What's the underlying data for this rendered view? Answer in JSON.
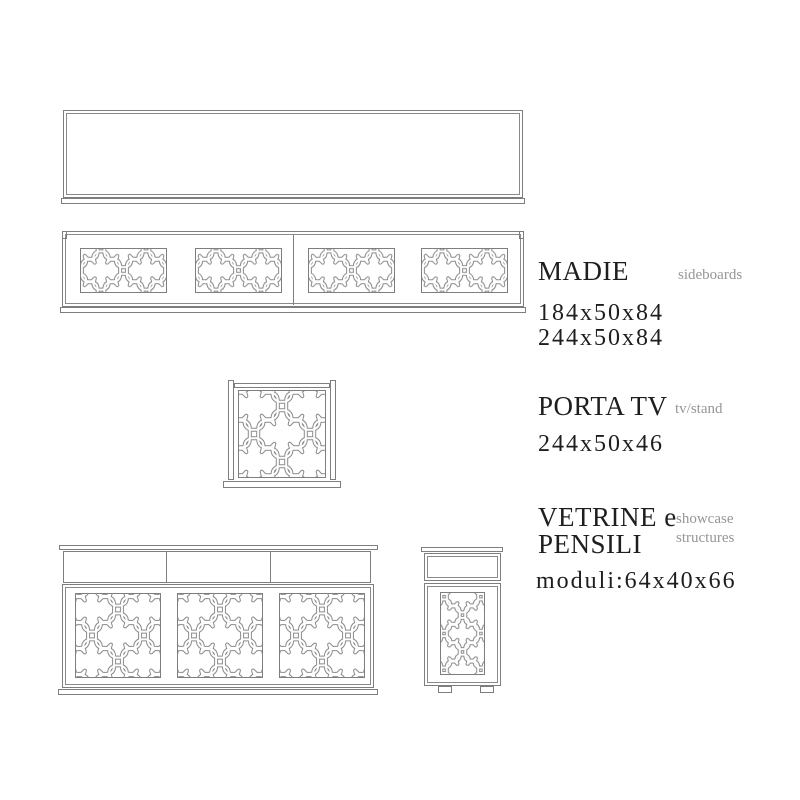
{
  "palette": {
    "background": "#ffffff",
    "drawing_line": "#7e7e7e",
    "pattern_line": "#8a8a8a",
    "text": "#1e1e1e",
    "muted_text": "#969696"
  },
  "sections": {
    "madie": {
      "title": "MADIE",
      "subtitle": "sideboards",
      "dims": [
        "184x50x84",
        "244x50x84"
      ]
    },
    "porta_tv": {
      "title": "PORTA TV",
      "subtitle": "tv/stand",
      "dims": [
        "244x50x46"
      ]
    },
    "vetrine_pensili": {
      "title_lines": [
        "VETRINE e",
        "PENSILI"
      ],
      "subtitle_lines": [
        "showcase",
        "structures"
      ],
      "dims": [
        "moduli:64x40x66"
      ]
    }
  }
}
